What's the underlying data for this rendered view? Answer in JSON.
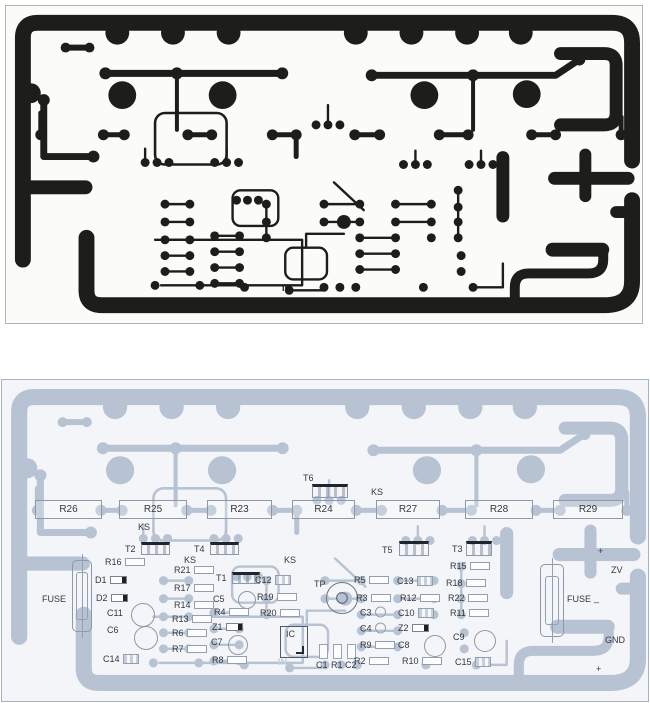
{
  "colors": {
    "copper_top": "#1d1d1b",
    "copper_bottom": "#b7c3d2",
    "bg_top": "#fbfbf7",
    "bg_bottom": "#f3f5f8",
    "label_color": "#35383e"
  },
  "top_board": {
    "in_label": "IN"
  },
  "bottom_board": {
    "in_label": "IN",
    "components": [
      {
        "l": "R26",
        "t": "rbox",
        "x": 33,
        "y": 120,
        "w": 67,
        "h": 19
      },
      {
        "l": "R25",
        "t": "rbox",
        "x": 117,
        "y": 120,
        "w": 68,
        "h": 19
      },
      {
        "l": "R23",
        "t": "rbox",
        "x": 205,
        "y": 120,
        "w": 65,
        "h": 19
      },
      {
        "l": "R24",
        "t": "rbox",
        "x": 290,
        "y": 120,
        "w": 63,
        "h": 19
      },
      {
        "l": "R27",
        "t": "rbox",
        "x": 374,
        "y": 120,
        "w": 64,
        "h": 19
      },
      {
        "l": "R28",
        "t": "rbox",
        "x": 463,
        "y": 120,
        "w": 68,
        "h": 19
      },
      {
        "l": "R29",
        "t": "rbox",
        "x": 551,
        "y": 120,
        "w": 70,
        "h": 19
      },
      {
        "t": "tsym",
        "x": 310,
        "y": 104,
        "w": 36,
        "h": 14
      },
      {
        "t": "tsym",
        "x": 139,
        "y": 162,
        "w": 29,
        "h": 13
      },
      {
        "t": "tsym",
        "x": 208,
        "y": 162,
        "w": 29,
        "h": 13
      },
      {
        "t": "tsym",
        "x": 397,
        "y": 161,
        "w": 30,
        "h": 15
      },
      {
        "t": "tsym",
        "x": 464,
        "y": 161,
        "w": 26,
        "h": 15
      },
      {
        "t": "tsym",
        "x": 230,
        "y": 192,
        "w": 28,
        "h": 12
      },
      {
        "l": "T6",
        "t": "t",
        "x": 301,
        "y": 98
      },
      {
        "l": "T2",
        "t": "t",
        "x": 123,
        "y": 169
      },
      {
        "l": "T4",
        "t": "t",
        "x": 192,
        "y": 169
      },
      {
        "l": "T5",
        "t": "t",
        "x": 380,
        "y": 170
      },
      {
        "l": "T3",
        "t": "t",
        "x": 450,
        "y": 169
      },
      {
        "l": "T1",
        "t": "t",
        "x": 214,
        "y": 198
      },
      {
        "l": "KS",
        "t": "t",
        "x": 136,
        "y": 147
      },
      {
        "l": "KS",
        "t": "t",
        "x": 182,
        "y": 180
      },
      {
        "l": "KS",
        "t": "t",
        "x": 282,
        "y": 180
      },
      {
        "l": "KS",
        "t": "t",
        "x": 369,
        "y": 112
      },
      {
        "l": "R16",
        "t": "r",
        "x": 103,
        "y": 182
      },
      {
        "l": "D1",
        "t": "d",
        "x": 93,
        "y": 200
      },
      {
        "l": "D2",
        "t": "d",
        "x": 94,
        "y": 218
      },
      {
        "l": "C11",
        "t": "t",
        "x": 105,
        "y": 233
      },
      {
        "l": "C6",
        "t": "t",
        "x": 105,
        "y": 250
      },
      {
        "l": "C14",
        "t": "ce",
        "x": 101,
        "y": 279
      },
      {
        "l": "R21",
        "t": "r",
        "x": 172,
        "y": 190
      },
      {
        "l": "R17",
        "t": "r",
        "x": 172,
        "y": 208
      },
      {
        "l": "R14",
        "t": "r",
        "x": 172,
        "y": 225
      },
      {
        "l": "R13",
        "t": "r",
        "x": 170,
        "y": 239
      },
      {
        "l": "R6",
        "t": "r",
        "x": 170,
        "y": 253
      },
      {
        "l": "R7",
        "t": "r",
        "x": 170,
        "y": 269
      },
      {
        "l": "R8",
        "t": "r",
        "x": 210,
        "y": 280
      },
      {
        "l": "C5",
        "t": "t",
        "x": 211,
        "y": 219
      },
      {
        "l": "R4",
        "t": "r",
        "x": 212,
        "y": 232
      },
      {
        "l": "Z1",
        "t": "d",
        "x": 210,
        "y": 247
      },
      {
        "l": "C7",
        "t": "t",
        "x": 209,
        "y": 262
      },
      {
        "l": "C12",
        "t": "ce",
        "x": 253,
        "y": 200
      },
      {
        "l": "R19",
        "t": "r",
        "x": 255,
        "y": 217
      },
      {
        "l": "R20",
        "t": "r",
        "x": 258,
        "y": 233
      },
      {
        "l": "IC",
        "t": "ic",
        "x": 278,
        "y": 246,
        "w": 28,
        "h": 32
      },
      {
        "l": "C1",
        "t": "t",
        "x": 314,
        "y": 285
      },
      {
        "l": "R1",
        "t": "t",
        "x": 329,
        "y": 285
      },
      {
        "l": "C2",
        "t": "t",
        "x": 343,
        "y": 285
      },
      {
        "t": "vres",
        "x": 317,
        "y": 264,
        "w": 9,
        "h": 15
      },
      {
        "t": "vres",
        "x": 331,
        "y": 264,
        "w": 9,
        "h": 15
      },
      {
        "t": "vres",
        "x": 345,
        "y": 264,
        "w": 9,
        "h": 15
      },
      {
        "l": "TP",
        "t": "t",
        "x": 312,
        "y": 204
      },
      {
        "t": "tpad",
        "x": 340,
        "y": 218,
        "w": 32,
        "h": 32
      },
      {
        "l": "R5",
        "t": "r",
        "x": 352,
        "y": 200
      },
      {
        "l": "R3",
        "t": "r",
        "x": 354,
        "y": 218
      },
      {
        "l": "C3",
        "t": "cc",
        "x": 358,
        "y": 232
      },
      {
        "l": "C4",
        "t": "cc",
        "x": 358,
        "y": 248
      },
      {
        "l": "R9",
        "t": "r",
        "x": 358,
        "y": 265
      },
      {
        "l": "R2",
        "t": "r",
        "x": 352,
        "y": 281
      },
      {
        "l": "C13",
        "t": "ce",
        "x": 395,
        "y": 201
      },
      {
        "l": "R12",
        "t": "r",
        "x": 398,
        "y": 218
      },
      {
        "l": "C10",
        "t": "ce",
        "x": 396,
        "y": 233
      },
      {
        "l": "Z2",
        "t": "d",
        "x": 396,
        "y": 248
      },
      {
        "l": "C8",
        "t": "t",
        "x": 396,
        "y": 265
      },
      {
        "l": "R10",
        "t": "r",
        "x": 400,
        "y": 281
      },
      {
        "l": "R15",
        "t": "r",
        "x": 448,
        "y": 186
      },
      {
        "l": "R18",
        "t": "r",
        "x": 444,
        "y": 203
      },
      {
        "l": "R22",
        "t": "r",
        "x": 446,
        "y": 218
      },
      {
        "l": "R11",
        "t": "r",
        "x": 448,
        "y": 233
      },
      {
        "l": "C9",
        "t": "t",
        "x": 451,
        "y": 257
      },
      {
        "l": "C15",
        "t": "ce",
        "x": 453,
        "y": 282
      },
      {
        "t": "circle",
        "x": 245,
        "y": 220,
        "w": 18
      },
      {
        "t": "circle",
        "x": 236,
        "y": 265,
        "w": 20
      },
      {
        "t": "circle",
        "x": 433,
        "y": 266,
        "w": 22
      },
      {
        "t": "circle",
        "x": 483,
        "y": 261,
        "w": 22
      },
      {
        "t": "circle",
        "x": 141,
        "y": 235,
        "w": 24
      },
      {
        "t": "circle",
        "x": 144,
        "y": 258,
        "w": 24
      },
      {
        "l": "FUSE",
        "t": "t",
        "x": 40,
        "y": 219
      },
      {
        "t": "fuse",
        "x": 70,
        "y": 180,
        "w": 20,
        "h": 72
      },
      {
        "l": "FUSE",
        "t": "t",
        "x": 565,
        "y": 219
      },
      {
        "t": "fuse",
        "x": 538,
        "y": 184,
        "w": 24,
        "h": 73
      },
      {
        "l": "+",
        "t": "t",
        "x": 596,
        "y": 171
      },
      {
        "l": "ZV",
        "t": "t",
        "x": 609,
        "y": 190
      },
      {
        "l": "_",
        "t": "t",
        "x": 592,
        "y": 218
      },
      {
        "l": "GND",
        "t": "t",
        "x": 603,
        "y": 260
      },
      {
        "l": "+",
        "t": "t",
        "x": 594,
        "y": 289
      }
    ]
  }
}
